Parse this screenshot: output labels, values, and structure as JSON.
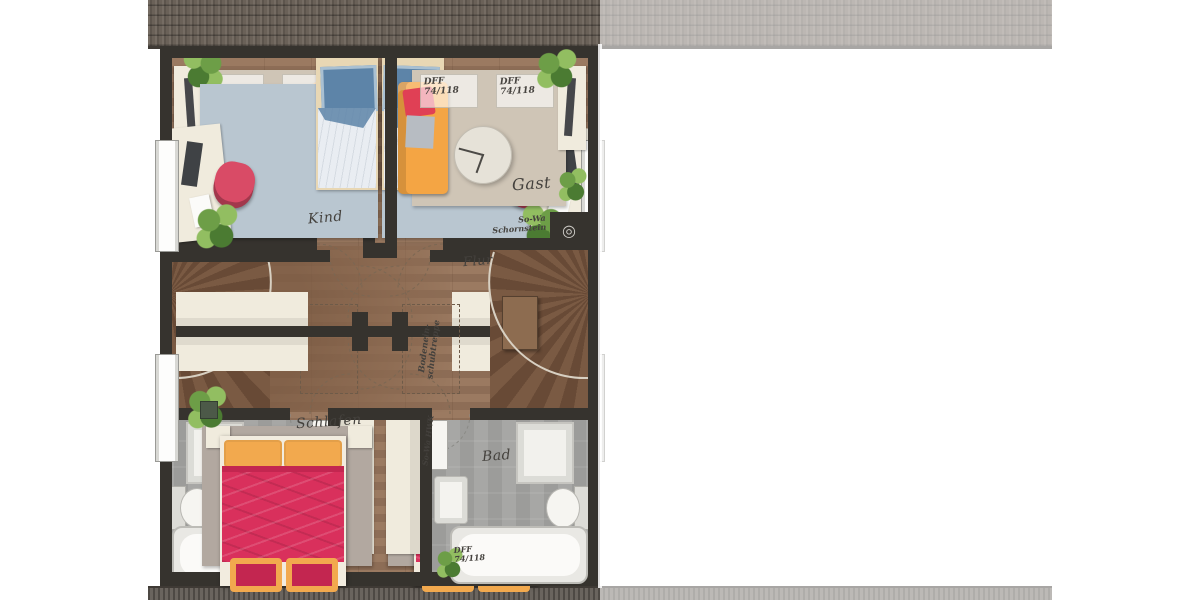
{
  "rooms": {
    "kind": "Kind",
    "gast": "Gast",
    "flur": "Flur",
    "schlafen": "Schlafen",
    "bad": "Bad"
  },
  "annotations": {
    "roof_window": {
      "l1": "DFF",
      "l2": "74/118"
    },
    "chimney": {
      "l1": "So-Wa",
      "l2": "Schornstein"
    },
    "attic_ladder": {
      "l1": "Bodenein-",
      "l2": "schubtreppe"
    },
    "duct": "So-Wa HWK"
  },
  "colors": {
    "wall": "#36332e",
    "wood_a": "#9b7a61",
    "wood_b": "#8d6d56",
    "hall_a": "#7b5a42",
    "hall_b": "#8a684f",
    "stair_a": "#7a5a43",
    "stair_b": "#684a36",
    "landing": "#8d6c50",
    "rug_kind": "#b9c6d0",
    "rug_gast": "#cfc5b6",
    "rug_schlafen": "#b2a8a0",
    "bath_a": "#9c9c9a",
    "bath_b": "#a7a7a5",
    "cream": "#f0ebdd",
    "sofa": "#f4a544",
    "pillow_red": "#e04055",
    "bed_red": "#d9305c",
    "bed_red_deep": "#c32650",
    "cushion_orange": "#f2a94e",
    "bed_blue": "#5d84a8",
    "bed_blue_light": "#a9c0d2",
    "sheet": "#e9edf2",
    "chair_red": "#d94b66",
    "plant_a": "#4d7a35",
    "plant_b": "#6f9d4a",
    "plant_c": "#93bd65"
  }
}
